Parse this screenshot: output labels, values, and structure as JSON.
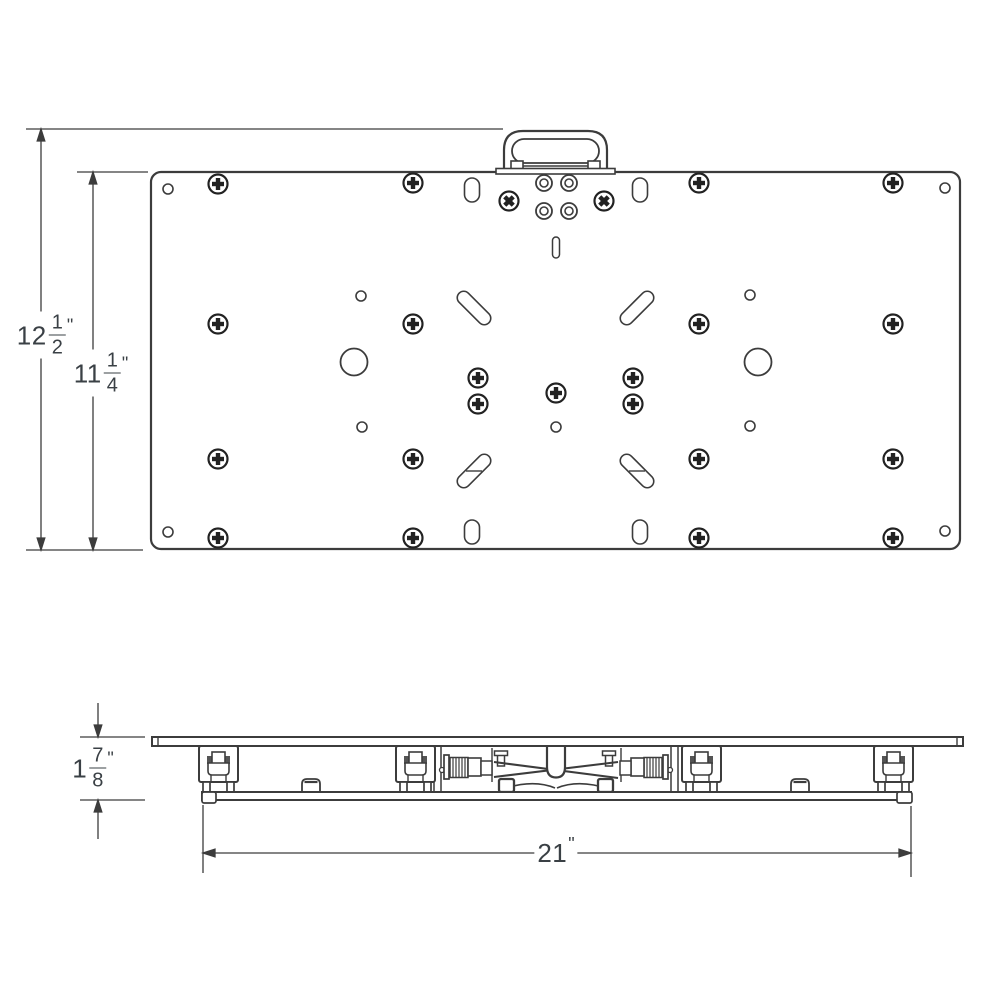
{
  "drawing": {
    "colors": {
      "background": "#ffffff",
      "line": "#3c3c3c",
      "text": "#3a4045"
    },
    "views": {
      "top": {
        "label": "top-view",
        "screw_count": 23,
        "grommet_count": 4,
        "small_hole_count": 9,
        "large_hole_count": 2,
        "vertical_slot_count": 4,
        "diagonal_slot_count": 4,
        "has_handle": true
      },
      "side": {
        "label": "side-view",
        "glide_count": 4,
        "spring_count": 2,
        "bump_count": 2
      }
    }
  },
  "dimensions": {
    "overall_height": {
      "whole": "12",
      "numerator": "1",
      "denominator": "2",
      "unit": "\""
    },
    "plate_height": {
      "whole": "11",
      "numerator": "1",
      "denominator": "4",
      "unit": "\""
    },
    "thickness": {
      "whole": "1",
      "numerator": "7",
      "denominator": "8",
      "unit": "\""
    },
    "width": {
      "whole": "21",
      "unit": "\""
    }
  }
}
